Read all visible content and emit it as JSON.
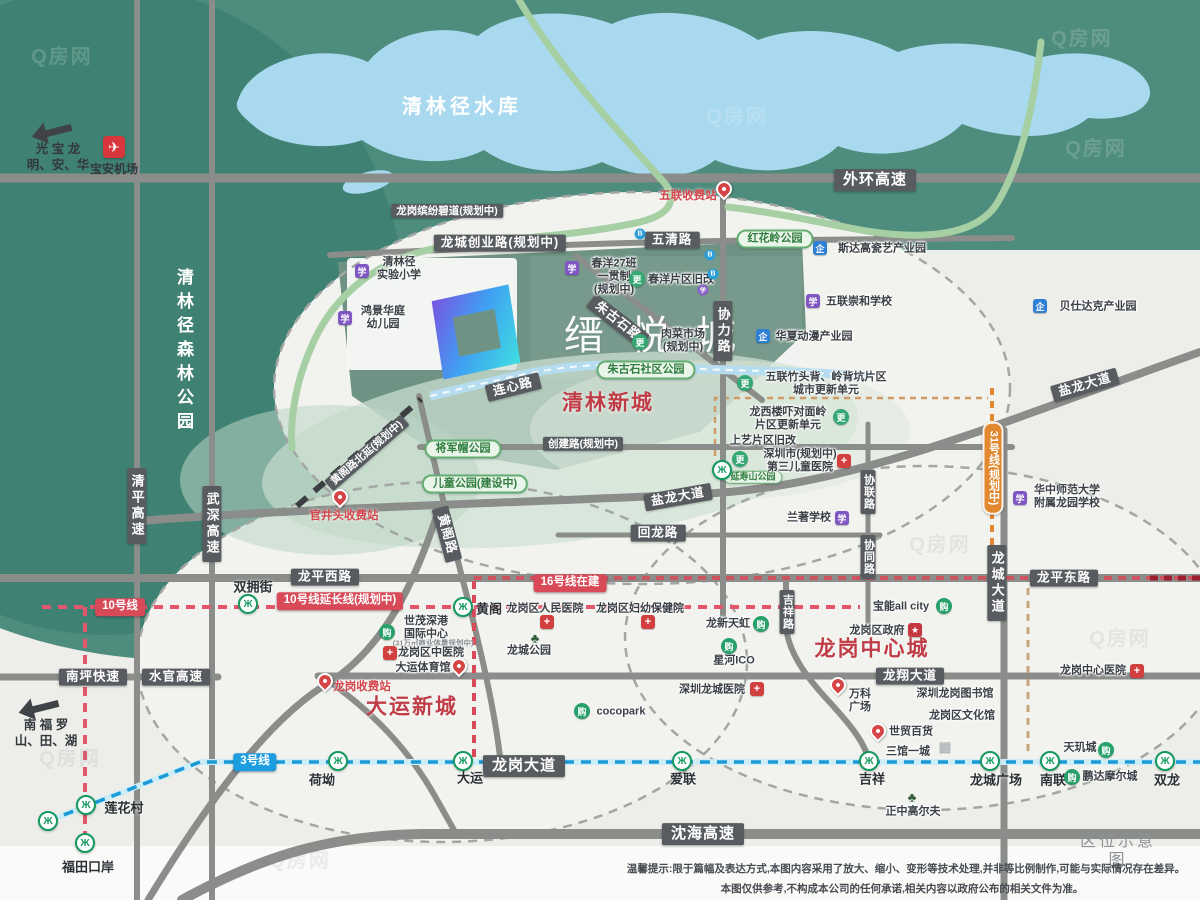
{
  "meta": {
    "sheet_title": "区位示意图",
    "watermark": "Q房网"
  },
  "project": {
    "name": "缙悦城"
  },
  "disclaimer": {
    "line1": "温馨提示:限于篇幅及表达方式,本图内容采用了放大、缩小、变形等技术处理,并非等比例制作,可能与实际情况存在差异。",
    "line2": "本图仅供参考,不构成本公司的任何承诺,相关内容以政府公布的相关文件为准。"
  },
  "icon_glyphs": {
    "metro": "Ж",
    "school": "学",
    "industry": "企",
    "mall": "购",
    "hospital": "+",
    "gov": "★",
    "renew": "更",
    "tree": "♣",
    "building": "▦",
    "dot-blue": "B",
    "dot-purple": "学",
    "plane": "✈",
    "pin": "",
    "arrow": ""
  },
  "labels": [
    {
      "n": "area-qinglin-newtown",
      "t": "清林新城",
      "x": 608,
      "y": 404,
      "c": "area"
    },
    {
      "n": "area-dayun-newtown",
      "t": "大运新城",
      "x": 412,
      "y": 708,
      "c": "area"
    },
    {
      "n": "area-longgang-central",
      "t": "龙岗中心城",
      "x": 872,
      "y": 650,
      "c": "area"
    },
    {
      "n": "label-qinglinjing-reservoir",
      "t": "清林径水库",
      "x": 462,
      "y": 108,
      "c": "water-name"
    },
    {
      "n": "label-qinglinjing-forest-park",
      "t": "清林径森林公园",
      "x": 183,
      "y": 352,
      "c": "forest-name"
    },
    {
      "n": "road-label-waihuan-expressway",
      "t": "外环高速",
      "x": 875,
      "y": 180,
      "c": "pill"
    },
    {
      "n": "road-label-wuqing-road",
      "t": "五清路",
      "x": 672,
      "y": 240,
      "c": "pill sm"
    },
    {
      "n": "road-label-longcheng-chuangye-road",
      "t": "龙城创业路(规划中)",
      "x": 500,
      "y": 243,
      "c": "pill sm"
    },
    {
      "n": "road-label-binfen-greenway",
      "t": "龙岗缤纷碧道(规划中)",
      "x": 447,
      "y": 211,
      "c": "pill xs"
    },
    {
      "n": "road-label-chuangjian-road",
      "t": "创建路(规划中)",
      "x": 583,
      "y": 444,
      "c": "pill xs"
    },
    {
      "n": "road-label-yanlong-avenue-west",
      "t": "盐龙大道",
      "x": 678,
      "y": 497,
      "c": "pill sm",
      "r": -10
    },
    {
      "n": "road-label-yanlong-avenue-east",
      "t": "盐龙大道",
      "x": 1085,
      "y": 385,
      "c": "pill sm",
      "r": -16
    },
    {
      "n": "road-label-huilong-road",
      "t": "回龙路",
      "x": 658,
      "y": 533,
      "c": "pill sm"
    },
    {
      "n": "road-label-longping-west-road",
      "t": "龙平西路",
      "x": 325,
      "y": 577,
      "c": "pill sm"
    },
    {
      "n": "road-label-longping-east-road",
      "t": "龙平东路",
      "x": 1064,
      "y": 578,
      "c": "pill sm"
    },
    {
      "n": "road-label-longxiang-avenue",
      "t": "龙翔大道",
      "x": 910,
      "y": 676,
      "c": "pill sm"
    },
    {
      "n": "road-label-longgang-avenue",
      "t": "龙岗大道",
      "x": 524,
      "y": 766,
      "c": "pill"
    },
    {
      "n": "road-label-shenhai-expressway",
      "t": "沈海高速",
      "x": 703,
      "y": 834,
      "c": "pill"
    },
    {
      "n": "road-label-nanping-expressway",
      "t": "南坪快速",
      "x": 93,
      "y": 677,
      "c": "pill sm"
    },
    {
      "n": "road-label-shuiguan-expressway",
      "t": "水官高速",
      "x": 176,
      "y": 677,
      "c": "pill sm"
    },
    {
      "n": "road-label-lianxin-road",
      "t": "连心路",
      "x": 513,
      "y": 387,
      "c": "pill sm",
      "r": -14
    },
    {
      "n": "road-label-zhugushi-road",
      "t": "朱古石路",
      "x": 618,
      "y": 321,
      "c": "pill sm",
      "r": 38
    },
    {
      "n": "road-label-huangge-road",
      "t": "黄阁路",
      "x": 447,
      "y": 534,
      "c": "pill sm",
      "r": 75
    },
    {
      "n": "road-label-huangge-north-extension",
      "t": "黄阁路北延(规划中)",
      "x": 367,
      "y": 453,
      "c": "pill xs",
      "r": -41
    },
    {
      "n": "road-label-xieli-road",
      "t": "协力路",
      "x": 723,
      "y": 331,
      "c": "pill v"
    },
    {
      "n": "road-label-xielian-road",
      "t": "协联路",
      "x": 868,
      "y": 492,
      "c": "pill v xs"
    },
    {
      "n": "road-label-xietong-road",
      "t": "协同路",
      "x": 868,
      "y": 557,
      "c": "pill v xs"
    },
    {
      "n": "road-label-jixiang-road",
      "t": "吉祥路",
      "x": 787,
      "y": 612,
      "c": "pill v xs"
    },
    {
      "n": "road-label-longcheng-avenue",
      "t": "龙城大道",
      "x": 997,
      "y": 583,
      "c": "pill v"
    },
    {
      "n": "road-label-qingping-expressway",
      "t": "清平高速",
      "x": 137,
      "y": 506,
      "c": "pill v"
    },
    {
      "n": "road-label-wushen-expressway",
      "t": "武深高速",
      "x": 212,
      "y": 524,
      "c": "pill v"
    },
    {
      "n": "metro-line10-badge",
      "t": "10号线",
      "x": 120,
      "y": 607,
      "c": "mpill red"
    },
    {
      "n": "metro-line10-extension-badge",
      "t": "10号线延长线(规划中)",
      "x": 340,
      "y": 601,
      "c": "mpill red"
    },
    {
      "n": "metro-line16-badge",
      "t": "16号线在建",
      "x": 570,
      "y": 583,
      "c": "mpill red"
    },
    {
      "n": "metro-line3-badge",
      "t": "3号线",
      "x": 255,
      "y": 762,
      "c": "mpill blue"
    },
    {
      "n": "metro-line31-badge",
      "t": "31号线(规划中)",
      "x": 993,
      "y": 468,
      "c": "mpill orange v"
    },
    {
      "n": "station-shuangyongjie",
      "t": "双拥街",
      "x": 253,
      "y": 587,
      "c": "station"
    },
    {
      "n": "station-huangge",
      "t": "黄阁",
      "x": 489,
      "y": 609,
      "c": "station"
    },
    {
      "n": "station-lianhuacun",
      "t": "莲花村",
      "x": 124,
      "y": 808,
      "c": "station"
    },
    {
      "n": "station-futian-checkpoint",
      "t": "福田口岸",
      "x": 88,
      "y": 867,
      "c": "station"
    },
    {
      "n": "station-heao",
      "t": "荷坳",
      "x": 322,
      "y": 780,
      "c": "station"
    },
    {
      "n": "station-dayun",
      "t": "大运",
      "x": 470,
      "y": 778,
      "c": "station"
    },
    {
      "n": "station-ailian",
      "t": "爱联",
      "x": 683,
      "y": 779,
      "c": "station"
    },
    {
      "n": "station-jixiang",
      "t": "吉祥",
      "x": 872,
      "y": 779,
      "c": "station"
    },
    {
      "n": "station-longcheng-square",
      "t": "龙城广场",
      "x": 996,
      "y": 780,
      "c": "station"
    },
    {
      "n": "station-nanlian",
      "t": "南联",
      "x": 1053,
      "y": 780,
      "c": "station"
    },
    {
      "n": "station-shuanglong",
      "t": "双龙",
      "x": 1167,
      "y": 780,
      "c": "station"
    },
    {
      "n": "poi-wulian-toll",
      "t": "五联收费站",
      "x": 688,
      "y": 197,
      "c": "red-poi"
    },
    {
      "n": "poi-guanjingtou-toll",
      "t": "官井头收费站",
      "x": 344,
      "y": 517,
      "c": "red-poi"
    },
    {
      "n": "poi-longgang-toll",
      "t": "龙岗收费站",
      "x": 362,
      "y": 688,
      "c": "red-poi"
    },
    {
      "n": "park-honghualing",
      "t": "红花岭公园",
      "x": 775,
      "y": 239,
      "c": "gpill"
    },
    {
      "n": "park-zhugushi-community",
      "t": "朱古石社区公园",
      "x": 646,
      "y": 370,
      "c": "gpill"
    },
    {
      "n": "park-jiangjunmao",
      "t": "将军帽公园",
      "x": 463,
      "y": 449,
      "c": "gpill"
    },
    {
      "n": "park-children",
      "t": "儿童公园(建设中)",
      "x": 475,
      "y": 484,
      "c": "gpill"
    },
    {
      "n": "park-yanshoushan",
      "t": "延寿山公园",
      "x": 753,
      "y": 477,
      "c": "gpill xs"
    },
    {
      "n": "poi-sidagao-ceramic-park",
      "t": "斯达高瓷艺产业园",
      "x": 882,
      "y": 249,
      "c": "poi"
    },
    {
      "n": "poi-beishidake-industrial-park",
      "t": "贝仕达克产业园",
      "x": 1098,
      "y": 307,
      "c": "poi"
    },
    {
      "n": "poi-wulian-chonghe-school",
      "t": "五联崇和学校",
      "x": 859,
      "y": 302,
      "c": "poi"
    },
    {
      "n": "poi-huaxia-anime-park",
      "t": "华夏动漫产业园",
      "x": 814,
      "y": 337,
      "c": "poi"
    },
    {
      "n": "poi-qinglinjing-experimental-primary",
      "t": "清林径\n实验小学",
      "x": 399,
      "y": 269,
      "c": "poi"
    },
    {
      "n": "poi-hongjing-huating-kindergarten",
      "t": "鸿景华庭\n幼儿园",
      "x": 383,
      "y": 318,
      "c": "poi"
    },
    {
      "n": "poi-chunyang-27class-school",
      "t": "春洋27班\n一贯制\n(规划中)",
      "x": 614,
      "y": 277,
      "c": "poi"
    },
    {
      "n": "poi-chunyang-renewal",
      "t": "春洋片区旧改",
      "x": 681,
      "y": 280,
      "c": "poi"
    },
    {
      "n": "poi-meat-market",
      "t": "肉菜市场\n(规划中)",
      "x": 683,
      "y": 341,
      "c": "poi"
    },
    {
      "n": "poi-wulian-zhutoubei-renewal",
      "t": "五联竹头背、岭背坑片区\n城市更新单元",
      "x": 826,
      "y": 384,
      "c": "poi"
    },
    {
      "n": "poi-longxi-louxia-renewal",
      "t": "龙西楼吓对面岭\n片区更新单元",
      "x": 788,
      "y": 419,
      "c": "poi"
    },
    {
      "n": "poi-shangyi-renewal",
      "t": "上艺片区旧改",
      "x": 763,
      "y": 441,
      "c": "poi"
    },
    {
      "n": "poi-third-children-hospital",
      "t": "深圳市(规划中)\n第三儿童医院",
      "x": 800,
      "y": 461,
      "c": "poi"
    },
    {
      "n": "poi-lanzhu-school",
      "t": "兰著学校",
      "x": 809,
      "y": 518,
      "c": "poi"
    },
    {
      "n": "poi-ccnu-longyuan-school",
      "t": "华中师范大学\n附属龙园学校",
      "x": 1067,
      "y": 497,
      "c": "poi"
    },
    {
      "n": "poi-longgang-peoples-hospital",
      "t": "龙岗区人民医院",
      "x": 545,
      "y": 609,
      "c": "poi"
    },
    {
      "n": "poi-longgang-maternity-hospital",
      "t": "龙岗区妇幼保健院",
      "x": 640,
      "y": 609,
      "c": "poi"
    },
    {
      "n": "poi-shimao-shengang-center",
      "t": "世茂深港\n国际中心",
      "x": 426,
      "y": 628,
      "c": "poi"
    },
    {
      "n": "poi-shimao-note",
      "t": "(31万㎡商业体量规划中)",
      "x": 433,
      "y": 644,
      "c": "tiny"
    },
    {
      "n": "poi-longgang-tcm-hospital",
      "t": "龙岗区中医院",
      "x": 431,
      "y": 653,
      "c": "poi"
    },
    {
      "n": "poi-dayun-gymnasium",
      "t": "大运体育馆",
      "x": 423,
      "y": 668,
      "c": "poi"
    },
    {
      "n": "poi-longcheng-park",
      "t": "龙城公园",
      "x": 529,
      "y": 651,
      "c": "poi"
    },
    {
      "n": "poi-cocopark",
      "t": "cocopark",
      "x": 621,
      "y": 712,
      "c": "poi"
    },
    {
      "n": "poi-longxin-tianhong",
      "t": "龙新天虹",
      "x": 728,
      "y": 624,
      "c": "poi"
    },
    {
      "n": "poi-xinghe-ico",
      "t": "星河ICO",
      "x": 734,
      "y": 661,
      "c": "poi"
    },
    {
      "n": "poi-baoneng-all-city",
      "t": "宝能all city",
      "x": 901,
      "y": 607,
      "c": "poi"
    },
    {
      "n": "poi-longgang-government",
      "t": "龙岗区政府",
      "x": 877,
      "y": 631,
      "c": "poi"
    },
    {
      "n": "poi-shenzhen-longcheng-hospital",
      "t": "深圳龙城医院",
      "x": 712,
      "y": 690,
      "c": "poi"
    },
    {
      "n": "poi-vanke-plaza",
      "t": "万科\n广场",
      "x": 860,
      "y": 701,
      "c": "poi"
    },
    {
      "n": "poi-shimao-department-store",
      "t": "世贸百货",
      "x": 911,
      "y": 732,
      "c": "poi"
    },
    {
      "n": "poi-longgang-library",
      "t": "深圳龙岗图书馆",
      "x": 955,
      "y": 694,
      "c": "poi"
    },
    {
      "n": "poi-longgang-cultural-center",
      "t": "龙岗区文化馆",
      "x": 962,
      "y": 716,
      "c": "poi"
    },
    {
      "n": "poi-sanguan-yicheng",
      "t": "三馆一城",
      "x": 908,
      "y": 752,
      "c": "poi"
    },
    {
      "n": "poi-zhengzhong-golf",
      "t": "正中高尔夫",
      "x": 913,
      "y": 812,
      "c": "poi"
    },
    {
      "n": "poi-longgang-central-hospital",
      "t": "龙岗中心医院",
      "x": 1093,
      "y": 671,
      "c": "poi"
    },
    {
      "n": "poi-tianjicheng",
      "t": "天玑城",
      "x": 1080,
      "y": 748,
      "c": "poi"
    },
    {
      "n": "poi-pengda-mall",
      "t": "鹏达摩尔城",
      "x": 1110,
      "y": 777,
      "c": "poi"
    },
    {
      "n": "sign-guangming-baoan-longhua",
      "t": "光 宝 龙\n明、安、华",
      "x": 58,
      "y": 157,
      "c": "dir"
    },
    {
      "n": "sign-nanshan-futian-luohu",
      "t": "南 福 罗\n山、田、湖",
      "x": 46,
      "y": 733,
      "c": "dir"
    },
    {
      "n": "sign-baoan-airport",
      "t": "宝安机场",
      "x": 114,
      "y": 170,
      "c": "dir sm"
    },
    {
      "n": "legend-title",
      "t": "区位示意图",
      "x": 1118,
      "y": 852,
      "c": "legend"
    },
    {
      "n": "disclaimer-line1",
      "t": "温馨提示:限于篇幅及表达方式,本图内容采用了放大、缩小、变形等技术处理,并非等比例制作,可能与实际情况存在差异。",
      "x": 906,
      "y": 869,
      "c": "disc"
    },
    {
      "n": "disclaimer-line2",
      "t": "本图仅供参考,不构成本公司的任何承诺,相关内容以政府公布的相关文件为准。",
      "x": 902,
      "y": 889,
      "c": "disc"
    },
    {
      "n": "watermark",
      "t": "Q房网",
      "x": 62,
      "y": 58,
      "c": "wm"
    },
    {
      "n": "watermark",
      "t": "Q房网",
      "x": 737,
      "y": 118,
      "c": "wm"
    },
    {
      "n": "watermark",
      "t": "Q房网",
      "x": 1082,
      "y": 40,
      "c": "wm"
    },
    {
      "n": "watermark",
      "t": "Q房网",
      "x": 1096,
      "y": 150,
      "c": "wm"
    },
    {
      "n": "watermark",
      "t": "Q房网",
      "x": 940,
      "y": 546,
      "c": "wm2"
    },
    {
      "n": "watermark",
      "t": "Q房网",
      "x": 70,
      "y": 760,
      "c": "wm2"
    },
    {
      "n": "watermark",
      "t": "Q房网",
      "x": 1120,
      "y": 640,
      "c": "wm2"
    },
    {
      "n": "watermark",
      "t": "Q房网",
      "x": 300,
      "y": 862,
      "c": "wm2"
    },
    {
      "n": "metro-icon-shuangyongjie",
      "i": "metro",
      "x": 248,
      "y": 604
    },
    {
      "n": "metro-icon-huangge",
      "i": "metro",
      "x": 463,
      "y": 607
    },
    {
      "n": "metro-icon-lianhuacun",
      "i": "metro",
      "x": 86,
      "y": 805
    },
    {
      "n": "metro-icon-line3-terminus",
      "i": "metro",
      "x": 48,
      "y": 821
    },
    {
      "n": "metro-icon-futian-checkpoint",
      "i": "metro",
      "x": 85,
      "y": 843
    },
    {
      "n": "metro-icon-heao",
      "i": "metro",
      "x": 338,
      "y": 761
    },
    {
      "n": "metro-icon-dayun",
      "i": "metro",
      "x": 463,
      "y": 761
    },
    {
      "n": "metro-icon-ailian",
      "i": "metro",
      "x": 682,
      "y": 761
    },
    {
      "n": "metro-icon-jixiang",
      "i": "metro",
      "x": 869,
      "y": 761
    },
    {
      "n": "metro-icon-longcheng-square",
      "i": "metro",
      "x": 990,
      "y": 761
    },
    {
      "n": "metro-icon-nanlian",
      "i": "metro",
      "x": 1050,
      "y": 761
    },
    {
      "n": "metro-icon-shuanglong",
      "i": "metro",
      "x": 1165,
      "y": 761
    },
    {
      "n": "metro-icon-yanshoushan",
      "i": "metro",
      "x": 722,
      "y": 470
    },
    {
      "n": "pin-icon-wulian-toll",
      "i": "pin",
      "x": 724,
      "y": 189,
      "r": -45
    },
    {
      "n": "pin-icon-guanjingtou-toll",
      "i": "pin",
      "x": 340,
      "y": 497,
      "r": -45
    },
    {
      "n": "pin-icon-longgang-toll",
      "i": "pin",
      "x": 325,
      "y": 681,
      "r": -45
    },
    {
      "n": "pin-icon-vanke-plaza",
      "i": "pin",
      "x": 838,
      "y": 685,
      "r": -45
    },
    {
      "n": "pin-icon-shimao-store",
      "i": "pin",
      "x": 878,
      "y": 731,
      "r": -45
    },
    {
      "n": "pin-icon-dayun-gym",
      "i": "pin",
      "x": 459,
      "y": 666,
      "r": -45
    },
    {
      "n": "school-icon-qinglinjing-primary",
      "i": "school",
      "x": 362,
      "y": 271
    },
    {
      "n": "school-icon-hongjing-kindergarten",
      "i": "school",
      "x": 345,
      "y": 318
    },
    {
      "n": "school-icon-chunyang",
      "i": "school",
      "x": 572,
      "y": 268
    },
    {
      "n": "school-icon-wulian-chonghe",
      "i": "school",
      "x": 813,
      "y": 301
    },
    {
      "n": "school-icon-lanzhu",
      "i": "school",
      "x": 842,
      "y": 518
    },
    {
      "n": "school-icon-ccnu-longyuan",
      "i": "school",
      "x": 1020,
      "y": 498
    },
    {
      "n": "industry-icon-sidagao",
      "i": "industry",
      "x": 820,
      "y": 248
    },
    {
      "n": "industry-icon-beishidake",
      "i": "industry",
      "x": 1040,
      "y": 306
    },
    {
      "n": "industry-icon-huaxia-anime",
      "i": "industry",
      "x": 763,
      "y": 336
    },
    {
      "n": "mall-icon-shimao-center",
      "i": "mall",
      "x": 387,
      "y": 632
    },
    {
      "n": "mall-icon-cocopark",
      "i": "mall",
      "x": 582,
      "y": 711
    },
    {
      "n": "mall-icon-longxin-tianhong",
      "i": "mall",
      "x": 761,
      "y": 624
    },
    {
      "n": "mall-icon-xinghe-ico",
      "i": "mall",
      "x": 729,
      "y": 646
    },
    {
      "n": "mall-icon-baoneng",
      "i": "mall",
      "x": 944,
      "y": 606
    },
    {
      "n": "mall-icon-tianjicheng",
      "i": "mall",
      "x": 1106,
      "y": 750
    },
    {
      "n": "mall-icon-pengda",
      "i": "mall",
      "x": 1072,
      "y": 777
    },
    {
      "n": "hospital-icon-third-children",
      "i": "hospital",
      "x": 844,
      "y": 461
    },
    {
      "n": "hospital-icon-peoples",
      "i": "hospital",
      "x": 547,
      "y": 622
    },
    {
      "n": "hospital-icon-maternity",
      "i": "hospital",
      "x": 648,
      "y": 622
    },
    {
      "n": "hospital-icon-tcm",
      "i": "hospital",
      "x": 390,
      "y": 653
    },
    {
      "n": "hospital-icon-longcheng",
      "i": "hospital",
      "x": 757,
      "y": 689
    },
    {
      "n": "hospital-icon-central",
      "i": "hospital",
      "x": 1137,
      "y": 671
    },
    {
      "n": "gov-icon-longgang-government",
      "i": "gov",
      "x": 915,
      "y": 630
    },
    {
      "n": "renew-icon-chunyang",
      "i": "renew",
      "x": 637,
      "y": 279
    },
    {
      "n": "renew-icon-meat-market",
      "i": "renew",
      "x": 640,
      "y": 342
    },
    {
      "n": "renew-icon-zhutoubei",
      "i": "renew",
      "x": 745,
      "y": 383
    },
    {
      "n": "renew-icon-longxi",
      "i": "renew",
      "x": 841,
      "y": 417
    },
    {
      "n": "renew-icon-shangyi",
      "i": "renew",
      "x": 740,
      "y": 459
    },
    {
      "n": "tree-icon-longcheng-park",
      "i": "tree",
      "x": 535,
      "y": 638
    },
    {
      "n": "tree-icon-golf",
      "i": "tree",
      "x": 912,
      "y": 797
    },
    {
      "n": "building-icon-sanguan",
      "i": "building",
      "x": 945,
      "y": 747
    },
    {
      "n": "dot-icon-blue-1",
      "i": "dot-blue",
      "x": 640,
      "y": 234
    },
    {
      "n": "dot-icon-blue-2",
      "i": "dot-blue",
      "x": 710,
      "y": 255
    },
    {
      "n": "dot-icon-blue-3",
      "i": "dot-blue",
      "x": 713,
      "y": 274
    },
    {
      "n": "dot-icon-purple-1",
      "i": "dot-purple",
      "x": 703,
      "y": 290
    },
    {
      "n": "airport-icon",
      "i": "plane",
      "x": 114,
      "y": 147
    },
    {
      "n": "arrow-icon-northwest",
      "i": "arrow",
      "x": 57,
      "y": 131,
      "r": -14
    },
    {
      "n": "arrow-icon-southwest",
      "i": "arrow",
      "x": 44,
      "y": 707,
      "r": -14
    }
  ]
}
